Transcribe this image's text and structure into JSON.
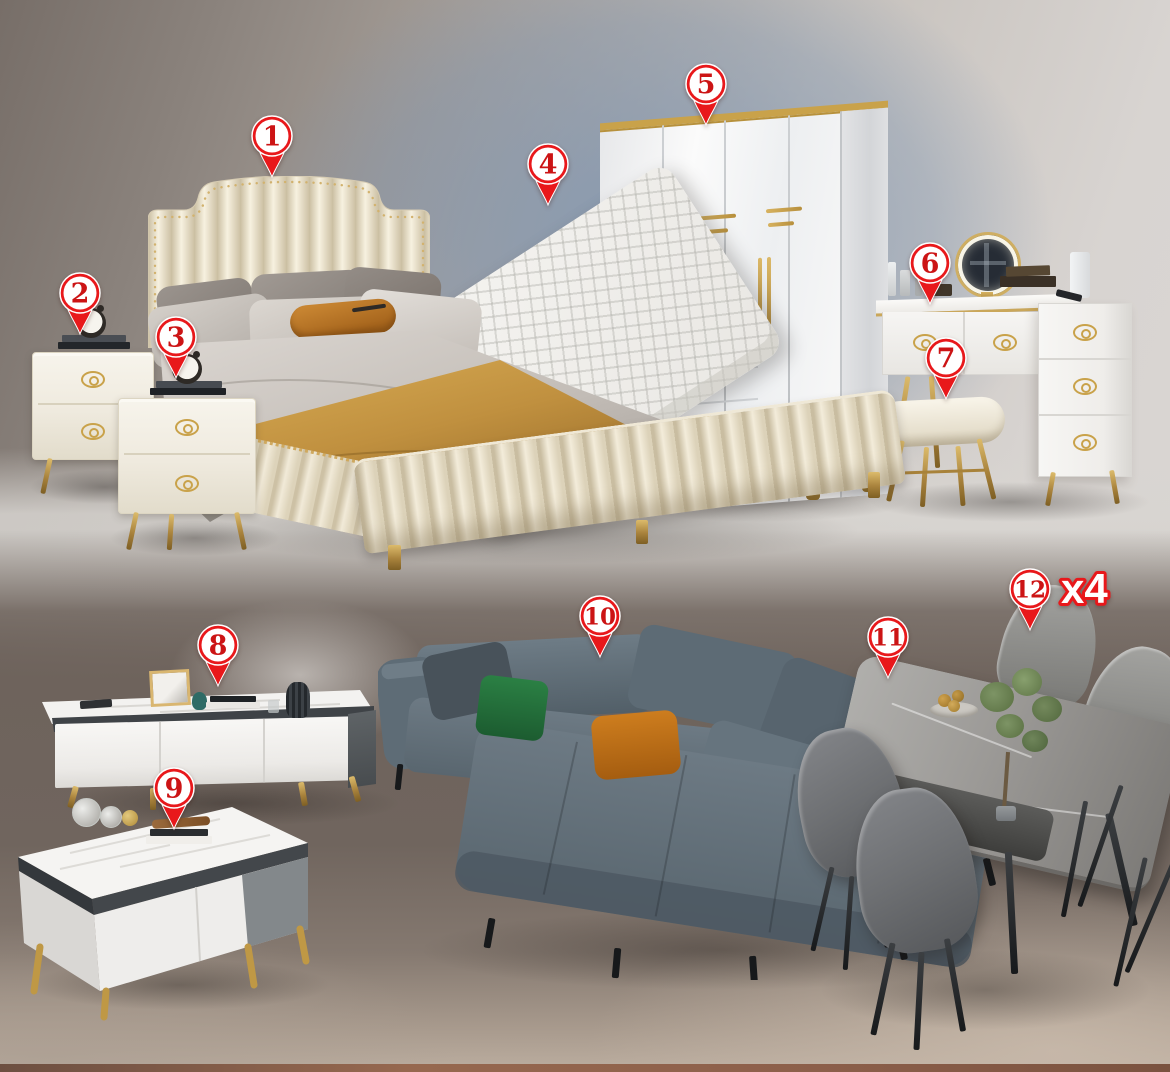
{
  "image": {
    "width": 1170,
    "height": 1072,
    "kind": "furniture-set-annotated-photo"
  },
  "palette": {
    "pin_red": "#e8181b",
    "pin_disc": "#ffffff",
    "pin_number": "#cc1415",
    "pin_edge": "#ffffff",
    "multiplier_fill": "#ffffff",
    "multiplier_stroke": "#e8181b"
  },
  "pins": [
    {
      "number": "1",
      "item": "bed",
      "x": 272,
      "y": 136
    },
    {
      "number": "2",
      "item": "nightstand-left",
      "x": 80,
      "y": 293
    },
    {
      "number": "3",
      "item": "nightstand-right",
      "x": 176,
      "y": 337
    },
    {
      "number": "4",
      "item": "mattress",
      "x": 548,
      "y": 164
    },
    {
      "number": "5",
      "item": "wardrobe",
      "x": 706,
      "y": 84
    },
    {
      "number": "6",
      "item": "dressing-table",
      "x": 930,
      "y": 263
    },
    {
      "number": "7",
      "item": "stool",
      "x": 946,
      "y": 358
    },
    {
      "number": "8",
      "item": "tv-stand",
      "x": 218,
      "y": 645
    },
    {
      "number": "9",
      "item": "coffee-table",
      "x": 174,
      "y": 788
    },
    {
      "number": "10",
      "item": "sofa",
      "x": 600,
      "y": 616
    },
    {
      "number": "11",
      "item": "dining-table",
      "x": 888,
      "y": 637
    },
    {
      "number": "12",
      "item": "dining-chair",
      "x": 1030,
      "y": 589,
      "multiplier": "x4"
    }
  ]
}
